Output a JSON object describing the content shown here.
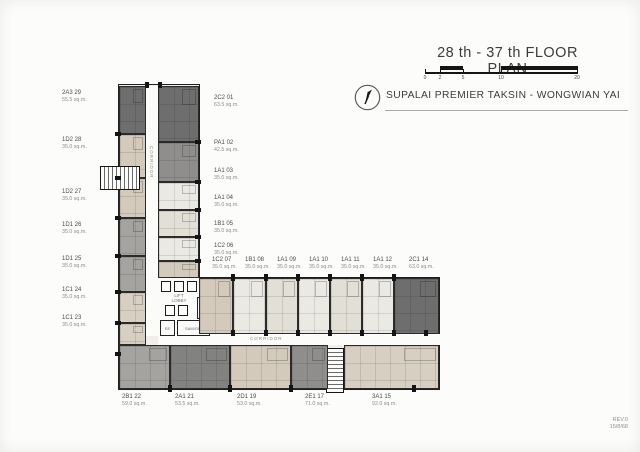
{
  "title_block": {
    "title": "28 th - 37 th FLOOR PLAN",
    "project": "SUPALAI PREMIER TAKSIN - WONGWIAN YAI",
    "scale_ticks": [
      "0",
      "2",
      "5",
      "10",
      "20"
    ]
  },
  "revision": {
    "rev": "REV.0",
    "date": "15/8/68"
  },
  "plan_labels": {
    "corridor_vertical": "CORRIDOR",
    "corridor_horizontal": "CORRIDOR",
    "lift_lobby": "LIFT LOBBY",
    "fireman_lobby": "FIREMAN LIFT LOBBY",
    "ee_room": "EE",
    "service_room": "SAM/GR."
  },
  "units": {
    "left": [
      {
        "id": "2A3 29",
        "area": "55.5 sq.m."
      },
      {
        "id": "1D2 28",
        "area": "35.0 sq.m."
      },
      {
        "id": "1D2 27",
        "area": "35.0 sq.m."
      },
      {
        "id": "1D1 26",
        "area": "35.0 sq.m."
      },
      {
        "id": "1D1 25",
        "area": "35.0 sq.m."
      },
      {
        "id": "1C1 24",
        "area": "35.0 sq.m."
      },
      {
        "id": "1C1 23",
        "area": "35.0 sq.m."
      }
    ],
    "right": [
      {
        "id": "2C2 01",
        "area": "63.5 sq.m."
      },
      {
        "id": "PA1 02",
        "area": "42.5 sq.m."
      },
      {
        "id": "1A1 03",
        "area": "35.0 sq.m."
      },
      {
        "id": "1A1 04",
        "area": "35.0 sq.m."
      },
      {
        "id": "1B1 05",
        "area": "35.0 sq.m."
      },
      {
        "id": "1C2 06",
        "area": "35.0 sq.m."
      }
    ],
    "top_row": [
      {
        "id": "1C2 07",
        "area": "35.0 sq.m."
      },
      {
        "id": "1B1 08",
        "area": "35.0 sq.m."
      },
      {
        "id": "1A1 09",
        "area": "35.0 sq.m."
      },
      {
        "id": "1A1 10",
        "area": "35.0 sq.m."
      },
      {
        "id": "1A1 11",
        "area": "35.0 sq.m."
      },
      {
        "id": "1A1 12",
        "area": "35.0 sq.m."
      },
      {
        "id": "2C1 14",
        "area": "63.0 sq.m."
      }
    ],
    "bottom_row": [
      {
        "id": "2B1 22",
        "area": "59.0 sq.m."
      },
      {
        "id": "2A1 21",
        "area": "53.5 sq.m."
      },
      {
        "id": "2D1 19",
        "area": "53.0 sq.m."
      },
      {
        "id": "2E1 17",
        "area": "71.0 sq.m."
      },
      {
        "id": "3A1 15",
        "area": "92.0 sq.m."
      }
    ]
  },
  "colors": {
    "unit_dark": "#6e6e6e",
    "unit_gray": "#8f8e8c",
    "unit_midgray": "#a4a3a0",
    "unit_beige": "#d3cabc",
    "unit_light": "#ebe9e3",
    "wall": "#1e1e1e",
    "paper": "#fcfcfb"
  }
}
